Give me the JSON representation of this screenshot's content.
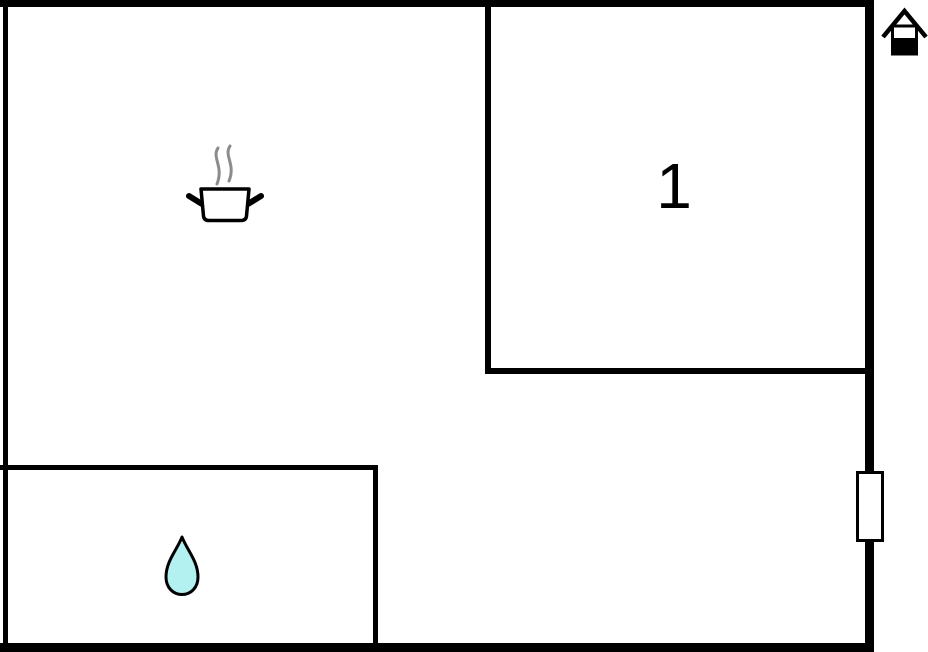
{
  "floorplan": {
    "rooms": [
      {
        "name": "room-1",
        "label": "1",
        "symbol": ""
      },
      {
        "name": "kitchen-area",
        "label": "",
        "symbol": "cooking-pot-icon"
      },
      {
        "name": "bathroom",
        "label": "",
        "symbol": "water-drop-icon"
      }
    ],
    "markers": [
      {
        "name": "window-marker",
        "location": "right-wall"
      },
      {
        "name": "house-logo-icon",
        "location": "top-right-outside"
      }
    ],
    "colors": {
      "wall": "#000000",
      "background": "#ffffff",
      "steam": "#8c8c8c",
      "icon_outline": "#000000",
      "water_drop_fill": "#b3f0f0",
      "pot_fill": "#ffffff",
      "window_fill": "#ffffff"
    }
  }
}
